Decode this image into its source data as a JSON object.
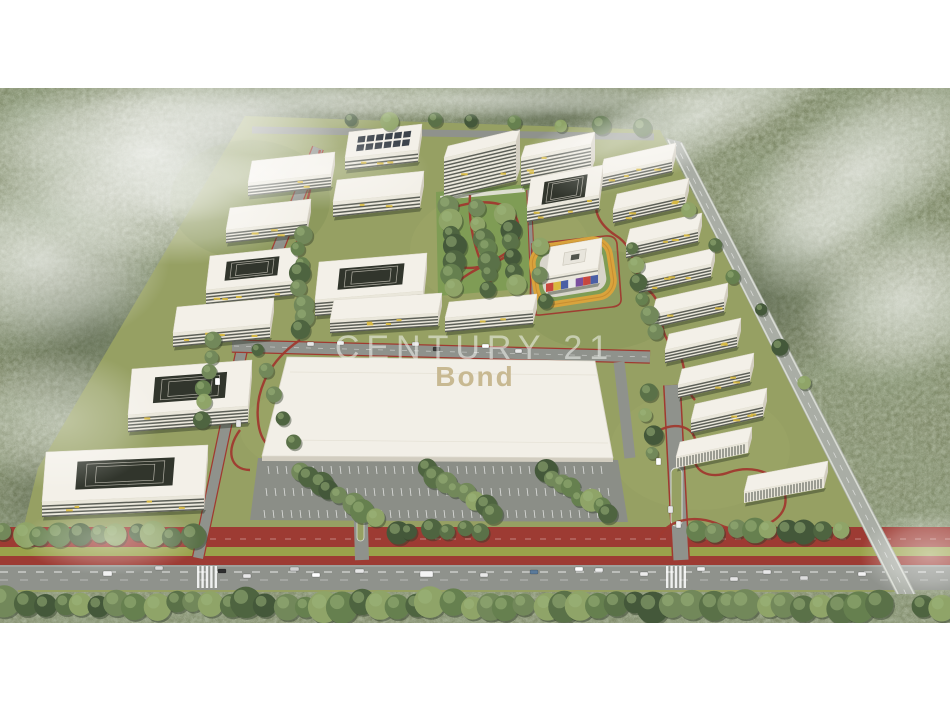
{
  "watermark": {
    "line1": "CENTURY 21",
    "line2": "Bond",
    "line1_color": "rgba(244,246,242,0.55)",
    "line2_color": "#c8b992"
  },
  "palette": {
    "frame": "#ffffff",
    "forest_base": "#7d8766",
    "forest_dark": "#55614a",
    "forest_light": "#9ead8c",
    "lawn": "#96a063",
    "park_green": "#7f9c55",
    "median_green": "#9aa24b",
    "roof": "#f3f0e8",
    "roof_shade": "#d6d2c5",
    "facade": "#eae7db",
    "facade_side": "#d2cdc0",
    "window_band": "#43463f",
    "accent_yellow": "#d9ba42",
    "courtyard_dark": "#31352c",
    "solar_panel": "#3c434b",
    "road": "#8f928c",
    "road_outer": "#a9ada5",
    "road_edge": "#d8dbd3",
    "red_lane": "#9d3b33",
    "red_path": "#a03a30",
    "track_orange": "#d9a33c",
    "parking": "#8b8e87",
    "big_roof": "#f2efe7",
    "shadow": "rgba(35,45,30,0.4)",
    "tree_greens": [
      "#44583a",
      "#4e6440",
      "#5a7148",
      "#66804f",
      "#72885a",
      "#8fa468"
    ],
    "kinder_colors": [
      "#c8473e",
      "#d9b93f",
      "#4a5fa5",
      "#e8e8e8",
      "#7a4f9e",
      "#c8473e",
      "#4a5fa5"
    ]
  },
  "scene": {
    "photo_top": 88,
    "photo_height": 535,
    "buildings": [
      [
        345,
        158,
        73,
        -8,
        26,
        12,
        "solar"
      ],
      [
        444,
        158,
        72,
        -17,
        12,
        40,
        "slab"
      ],
      [
        521,
        158,
        70,
        -14,
        12,
        28,
        "slab"
      ],
      [
        600,
        175,
        72,
        -16,
        16,
        13,
        "slab"
      ],
      [
        248,
        183,
        83,
        -9,
        22,
        13,
        "slab"
      ],
      [
        333,
        202,
        87,
        -9,
        22,
        15,
        "slab"
      ],
      [
        527,
        208,
        72,
        -13,
        30,
        14,
        "u"
      ],
      [
        613,
        210,
        72,
        -16,
        16,
        13,
        "slab"
      ],
      [
        226,
        230,
        81,
        -9,
        22,
        13,
        "slab"
      ],
      [
        626,
        245,
        72,
        -16,
        16,
        13,
        "slab"
      ],
      [
        639,
        280,
        72,
        -16,
        16,
        13,
        "slab"
      ],
      [
        546,
        277,
        52,
        -9,
        30,
        15,
        "kinder"
      ],
      [
        206,
        290,
        88,
        -9,
        34,
        14,
        "court"
      ],
      [
        315,
        300,
        108,
        -9,
        38,
        16,
        "court"
      ],
      [
        652,
        315,
        72,
        -16,
        16,
        13,
        "slab"
      ],
      [
        445,
        318,
        88,
        -8,
        16,
        14,
        "slab"
      ],
      [
        330,
        320,
        108,
        -7,
        20,
        13,
        "slab"
      ],
      [
        173,
        333,
        97,
        -9,
        26,
        14,
        "slab"
      ],
      [
        665,
        350,
        72,
        -16,
        16,
        13,
        "slab"
      ],
      [
        678,
        385,
        72,
        -16,
        16,
        13,
        "slab"
      ],
      [
        128,
        415,
        120,
        -9,
        46,
        17,
        "court"
      ],
      [
        691,
        420,
        72,
        -16,
        16,
        13,
        "slab"
      ],
      [
        676,
        457,
        72,
        -15,
        15,
        11,
        "striped"
      ],
      [
        744,
        492,
        80,
        -15,
        16,
        11,
        "striped"
      ],
      [
        42,
        502,
        162,
        -7,
        50,
        15,
        "court"
      ]
    ],
    "big_building": "287,357 595,361 613,458 262,456",
    "parking_poly": "258,458 618,460 628,522 250,520",
    "parking_rows": [
      [
        470,
        268,
        608
      ],
      [
        492,
        266,
        612
      ],
      [
        514,
        264,
        616
      ]
    ],
    "track": {
      "x": 531,
      "y": 240,
      "w": 84,
      "h": 64,
      "rx": 20,
      "rot": -9,
      "cx": 573,
      "cy": 272
    },
    "fog": [
      [
        150,
        150,
        190,
        75,
        0.8,
        0
      ],
      [
        40,
        260,
        130,
        90,
        0.65,
        0
      ],
      [
        250,
        110,
        170,
        45,
        0.55,
        0
      ],
      [
        60,
        420,
        100,
        70,
        0.4,
        0
      ],
      [
        110,
        540,
        90,
        35,
        0.4,
        0
      ],
      [
        480,
        100,
        260,
        20,
        0.5,
        0
      ],
      [
        700,
        115,
        170,
        45,
        0.6,
        -25
      ],
      [
        860,
        170,
        150,
        70,
        0.65,
        -30
      ],
      [
        905,
        300,
        110,
        80,
        0.6,
        -20
      ],
      [
        820,
        240,
        80,
        50,
        0.4,
        -30
      ],
      [
        930,
        555,
        70,
        45,
        0.5,
        0
      ],
      [
        590,
        140,
        90,
        25,
        0.35,
        -20
      ],
      [
        175,
        205,
        140,
        60,
        0.55,
        0
      ],
      [
        320,
        170,
        110,
        40,
        0.35,
        0
      ]
    ],
    "trees": [
      [
        8,
        604,
        878,
        606,
        48,
        13
      ],
      [
        922,
        604,
        945,
        607,
        2,
        12
      ],
      [
        4,
        533,
        190,
        535,
        11,
        11
      ],
      [
        395,
        530,
        478,
        531,
        6,
        10
      ],
      [
        700,
        531,
        838,
        533,
        9,
        11
      ],
      [
        300,
        235,
        302,
        330,
        8,
        9
      ],
      [
        215,
        340,
        200,
        420,
        6,
        8
      ],
      [
        645,
        395,
        652,
        455,
        4,
        8
      ],
      [
        630,
        250,
        655,
        330,
        6,
        8
      ],
      [
        447,
        205,
        455,
        290,
        7,
        10
      ],
      [
        480,
        210,
        490,
        288,
        7,
        10
      ],
      [
        508,
        215,
        520,
        285,
        6,
        9
      ],
      [
        540,
        245,
        542,
        300,
        3,
        7
      ],
      [
        302,
        470,
        372,
        515,
        8,
        10
      ],
      [
        425,
        468,
        492,
        514,
        8,
        10
      ],
      [
        545,
        470,
        610,
        515,
        8,
        10
      ],
      [
        692,
        210,
        802,
        380,
        6,
        7
      ],
      [
        255,
        350,
        290,
        440,
        5,
        8
      ],
      [
        350,
        118,
        640,
        125,
        8,
        8
      ]
    ],
    "cars": [
      [
        103,
        571,
        9,
        5,
        "#f2f2f2"
      ],
      [
        155,
        566,
        8,
        4,
        "#d8d8d8"
      ],
      [
        218,
        569,
        8,
        4,
        "#2e2e2e"
      ],
      [
        243,
        574,
        8,
        4,
        "#e8e8e8"
      ],
      [
        290,
        567,
        9,
        4,
        "#cfcfcf"
      ],
      [
        312,
        573,
        8,
        4,
        "#ffffff"
      ],
      [
        355,
        569,
        9,
        4,
        "#e6e6e6"
      ],
      [
        420,
        571,
        13,
        6,
        "#f4f4f4"
      ],
      [
        480,
        573,
        8,
        4,
        "#e8e8e8"
      ],
      [
        530,
        570,
        8,
        4,
        "#5a7a9a"
      ],
      [
        575,
        567,
        8,
        4,
        "#ffffff"
      ],
      [
        595,
        568,
        8,
        4,
        "#ececec"
      ],
      [
        640,
        572,
        8,
        4,
        "#ececec"
      ],
      [
        697,
        567,
        8,
        4,
        "#f0f0f0"
      ],
      [
        730,
        577,
        8,
        4,
        "#e4e4e4"
      ],
      [
        763,
        570,
        8,
        4,
        "#e8e8e8"
      ],
      [
        800,
        576,
        8,
        4,
        "#dcdcdc"
      ],
      [
        858,
        572,
        8,
        4,
        "#f2f2f2"
      ],
      [
        307,
        342,
        7,
        4,
        "#e8e8e8"
      ],
      [
        337,
        341,
        7,
        4,
        "#f0f0f0"
      ],
      [
        412,
        342,
        7,
        4,
        "#e4e4e4"
      ],
      [
        433,
        347,
        7,
        4,
        "#3a3a3a"
      ],
      [
        482,
        344,
        7,
        4,
        "#ffffff"
      ],
      [
        515,
        349,
        7,
        4,
        "#e8e8e8"
      ],
      [
        656,
        458,
        5,
        7,
        "#ffffff"
      ],
      [
        668,
        506,
        5,
        7,
        "#e8e8e8"
      ],
      [
        676,
        521,
        5,
        7,
        "#f0f0f0"
      ],
      [
        215,
        378,
        5,
        7,
        "#ffffff"
      ],
      [
        236,
        420,
        5,
        7,
        "#e8e8e8"
      ]
    ],
    "crosswalks": [
      197,
      666
    ],
    "lawn_poly": "245,116 660,130 900,592 18,592 18,550 38,468",
    "park_poly": "436,192 530,184 532,288 438,296"
  }
}
